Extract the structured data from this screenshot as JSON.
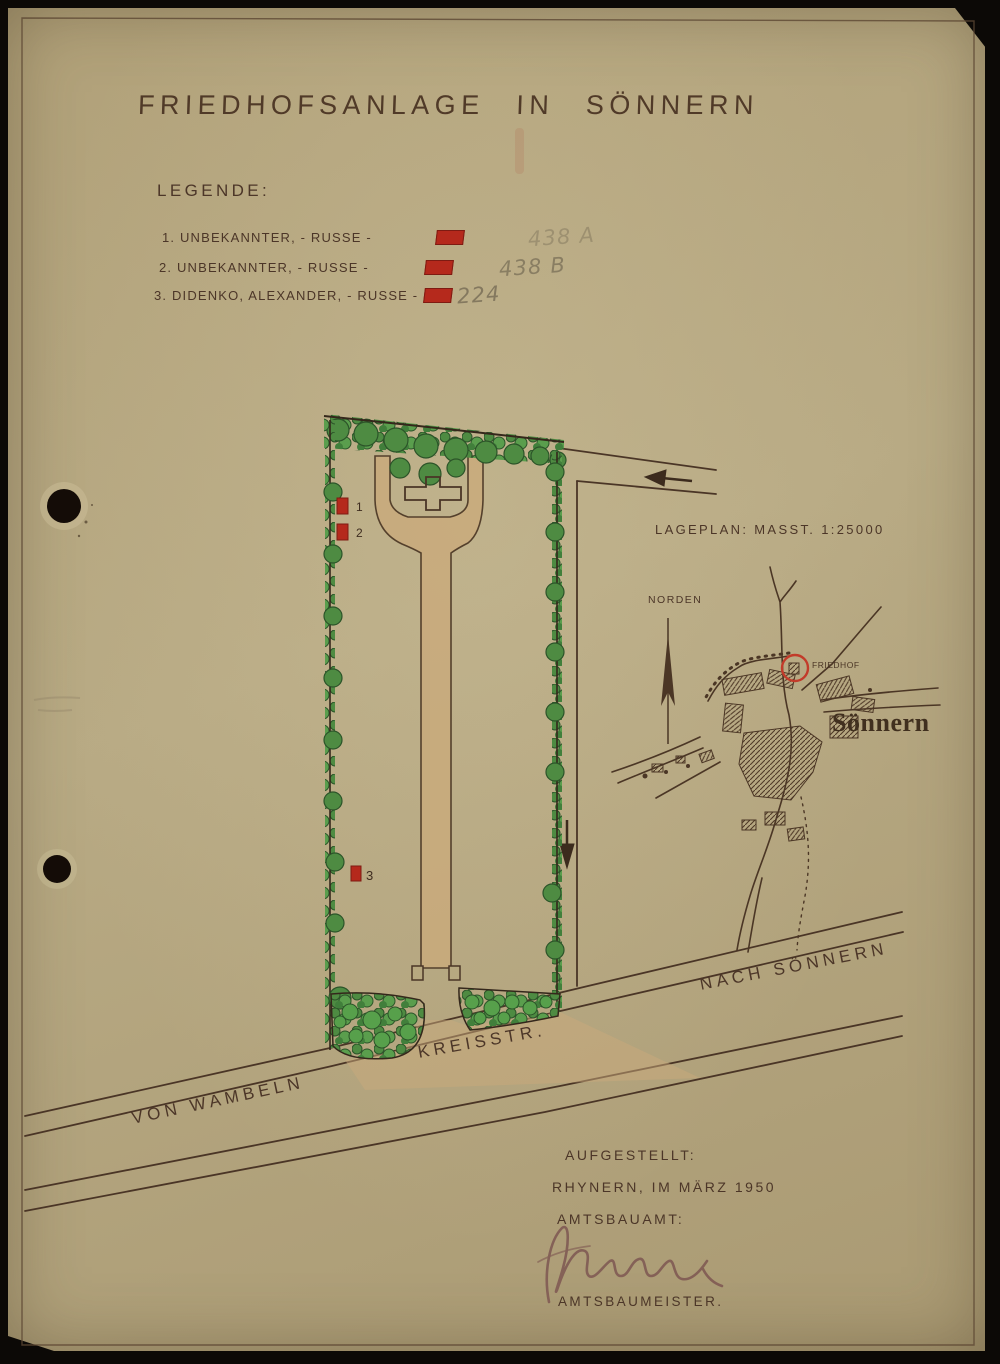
{
  "document": {
    "title": "FRIEDHOFSANLAGE IN SÖNNERN",
    "legend": {
      "heading": "LEGENDE:",
      "items": [
        {
          "number": "1.",
          "name": "UNBEKANNTER, - RUSSE -",
          "note": "438 A"
        },
        {
          "number": "2.",
          "name": "UNBEKANNTER, - RUSSE -",
          "note": "438 B"
        },
        {
          "number": "3.",
          "name": "DIDENKO, ALEXANDER, - RUSSE -",
          "note": "224"
        }
      ]
    },
    "plan": {
      "grave_labels": [
        "1",
        "2",
        "3"
      ],
      "roads": {
        "kreisstrasse": "KREISSTR.",
        "von_wambeln": "VON WAMBELN",
        "nach_soennern": "NACH SÖNNERN"
      }
    },
    "lageplan": {
      "caption": "LAGEPLAN: MASST. 1:25000",
      "north_label": "NORDEN",
      "friedhof_label": "FRIEDHOF",
      "village_label": "Sönnern"
    },
    "footer": {
      "line1": "AUFGESTELLT:",
      "line2": "RHYNERN, IM MÄRZ 1950",
      "line3": "AMTSBAUAMT:",
      "line4": "AMTSBAUMEISTER."
    },
    "colors": {
      "paper": "#b2a47c",
      "ink": "#4c3628",
      "hedge_green": "#4e8b42",
      "path_tan": "#c9aa7b",
      "marker_red": "#b5291c",
      "map_red": "#c23b2a"
    }
  }
}
